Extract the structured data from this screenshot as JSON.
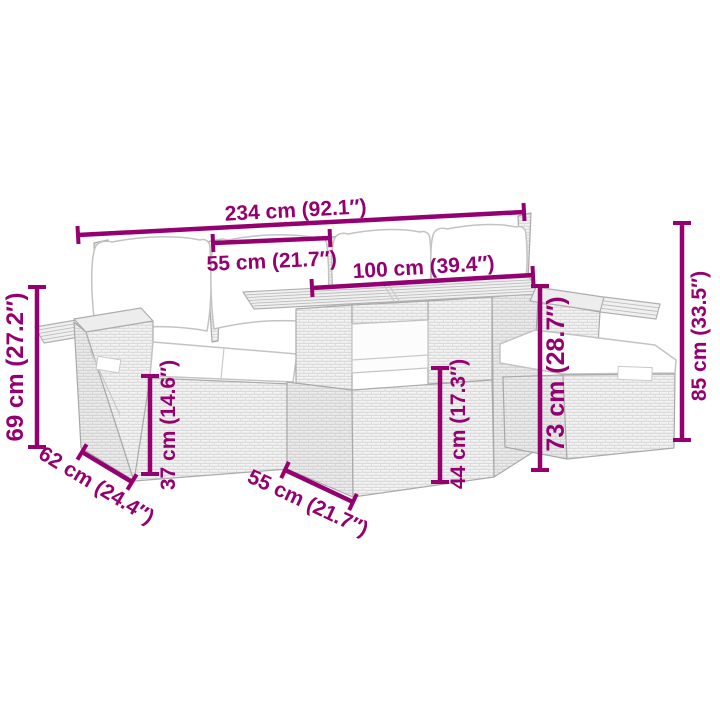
{
  "diagram": {
    "type": "product-dimension-diagram",
    "subject": "garden furniture set line illustration",
    "background": "#ffffff"
  },
  "colors": {
    "dimension_accent": "#950070",
    "illustration_line": "#b2b2b2",
    "cushion_fill": "#ffffff"
  },
  "measurements": {
    "dim_234": {
      "cm": 234,
      "inches": 92.1,
      "label": "234 cm (92.1″)"
    },
    "dim_55_top": {
      "cm": 55,
      "inches": 21.7,
      "label": "55 cm (21.7″)"
    },
    "dim_100": {
      "cm": 100,
      "inches": 39.4,
      "label": "100 cm (39.4″)"
    },
    "dim_69": {
      "cm": 69,
      "inches": 27.2,
      "label": "69 cm (27.2″)"
    },
    "dim_37": {
      "cm": 37,
      "inches": 14.6,
      "label": "37 cm (14.6″)"
    },
    "dim_62": {
      "cm": 62,
      "inches": 24.4,
      "label": "62 cm (24.4″)"
    },
    "dim_55_bottom": {
      "cm": 55,
      "inches": 21.7,
      "label": "55 cm (21.7″)"
    },
    "dim_44": {
      "cm": 44,
      "inches": 17.3,
      "label": "44 cm (17.3″)"
    },
    "dim_73": {
      "cm": 73,
      "inches": 28.7,
      "label": "73 cm (28.7″)"
    },
    "dim_85": {
      "cm": 85,
      "inches": 33.5,
      "label": "85 cm (33.5″)"
    }
  }
}
